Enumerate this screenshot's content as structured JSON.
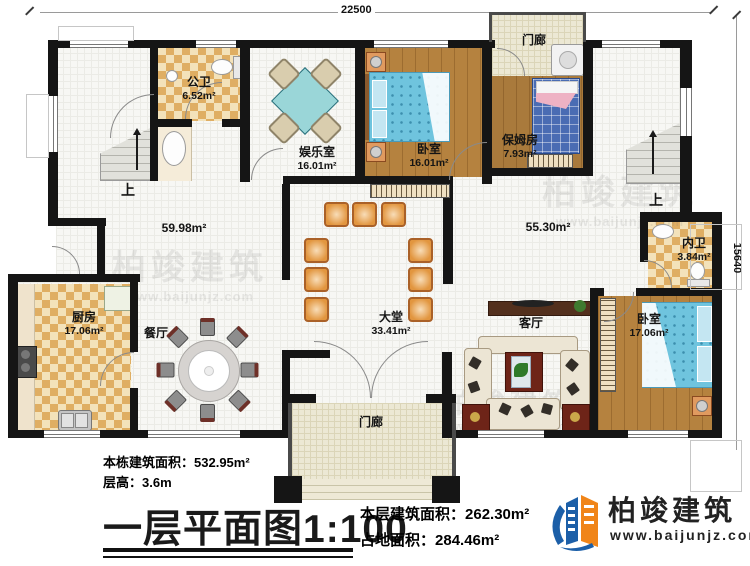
{
  "plan": {
    "dims": {
      "top": "22500",
      "right": "15640"
    },
    "rooms": {
      "gongwei": {
        "name": "公卫",
        "area": "6.52m²"
      },
      "yuleshi": {
        "name": "娱乐室",
        "area": "16.01m²"
      },
      "woshi_top": {
        "name": "卧室",
        "area": "16.01m²"
      },
      "menlang_top": {
        "name": "门廊"
      },
      "baomufang": {
        "name": "保姆房",
        "area": "7.93m²"
      },
      "neiwei": {
        "name": "内卫",
        "area": "3.84m²"
      },
      "woshi_right": {
        "name": "卧室",
        "area": "17.06m²"
      },
      "keting": {
        "name": "客厅"
      },
      "datang": {
        "name": "大堂",
        "area": "33.41m²"
      },
      "canting": {
        "name": "餐厅"
      },
      "chufang": {
        "name": "厨房",
        "area": "17.06m²"
      },
      "menlang_bottom": {
        "name": "门廊"
      },
      "hall_left_area": "59.98m²",
      "hall_right_area": "55.30m²",
      "up_left": "上",
      "up_right": "上"
    },
    "footer": {
      "building_area_label": "本栋建筑面积：",
      "building_area_value": "532.95m²",
      "floor_height_label": "层高：",
      "floor_height_value": "3.6m",
      "title": "一层平面图",
      "scale": "1:100",
      "floor_area_label": "本层建筑面积：",
      "floor_area_value": "262.30m²",
      "land_area_label": "占地面积：",
      "land_area_value": "284.46m²"
    },
    "logo": {
      "name": "柏竣建筑",
      "url": "www.baijunjz.com"
    },
    "watermark": {
      "name": "柏竣建筑",
      "url": "www.baijunjz.com"
    },
    "colors": {
      "wall": "#151515",
      "wood": "#b5823f",
      "tile_dark": "#dfae63",
      "tile_light": "#f3e2ba",
      "bed_blue": "#6fc4de",
      "chair_orange": "#e2963f",
      "logo_blue": "#1c5fa8",
      "logo_orange": "#f08519"
    }
  }
}
